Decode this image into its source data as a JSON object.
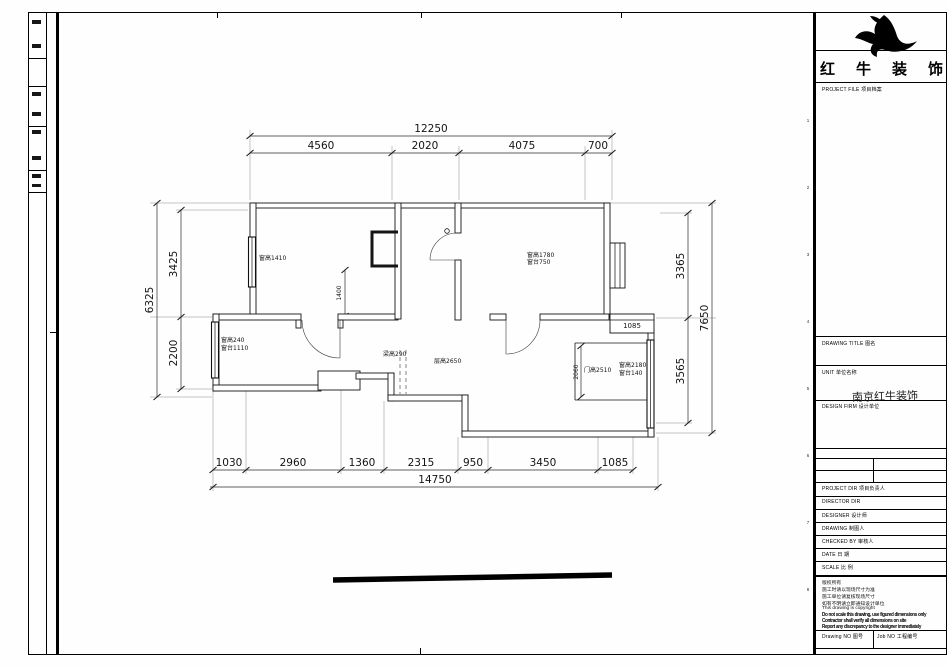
{
  "company": {
    "name": "红牛装饰"
  },
  "title_block": {
    "project_file": "PROJECT FILE  项目档案",
    "drawing_title": "DRAWING TITLE  图名",
    "unit": "UNIT  单位名称",
    "design_firm": "DESIGN FIRM  设计单位",
    "stamp": "南京红牛装饰",
    "rows": [
      "PROJECT DIR  项目负责人",
      "DIRECTOR DIR",
      "DESIGNER  设计师",
      "DRAWING  制图人",
      "CHECKED BY  审核人",
      "DATE  日 期",
      "SCALE  比 例"
    ],
    "notes": [
      "版权所有",
      "施工时请以现场尺寸为准",
      "施工单位请复核现场尺寸",
      "如有不明请立即通知设计单位",
      "This drawing is copyright",
      "Do not scale this drawing, use figured dimensions only",
      "Contractor shall verify all dimensions on site",
      "Report any discrepancy to the designer immediately"
    ],
    "drawing_no": "Drawing NO  图号",
    "job_no": "Job NO  工程编号",
    "ruler_marks": [
      "1",
      "2",
      "3",
      "4",
      "5",
      "6",
      "7",
      "8"
    ]
  },
  "plan": {
    "dims_top": {
      "overall": "12250",
      "segments": [
        "4560",
        "2020",
        "4075",
        "700"
      ]
    },
    "dims_left": {
      "overall": "6325",
      "segments": [
        "3425",
        "2200"
      ]
    },
    "dims_right": {
      "overall": "7650",
      "segments": [
        "3365",
        "3565"
      ]
    },
    "dims_bottom": {
      "overall": "14750",
      "segments": [
        "1030",
        "2960",
        "1360",
        "2315",
        "950",
        "3450",
        "1085"
      ]
    },
    "annotations": {
      "window_top_left": "窗高1410",
      "window_top_right_1": "窗高1780",
      "window_top_right_2": "窗台750",
      "window_mid_left_1": "窗高240",
      "window_mid_left_2": "窗台1110",
      "beam": "梁高290",
      "ceiling": "层高2650",
      "door": "门高2510",
      "window_lower_right_1": "窗高2180",
      "window_lower_right_2": "窗台140",
      "dim_1400": "1400",
      "dim_2060": "2060",
      "dim_1085": "1085"
    }
  }
}
